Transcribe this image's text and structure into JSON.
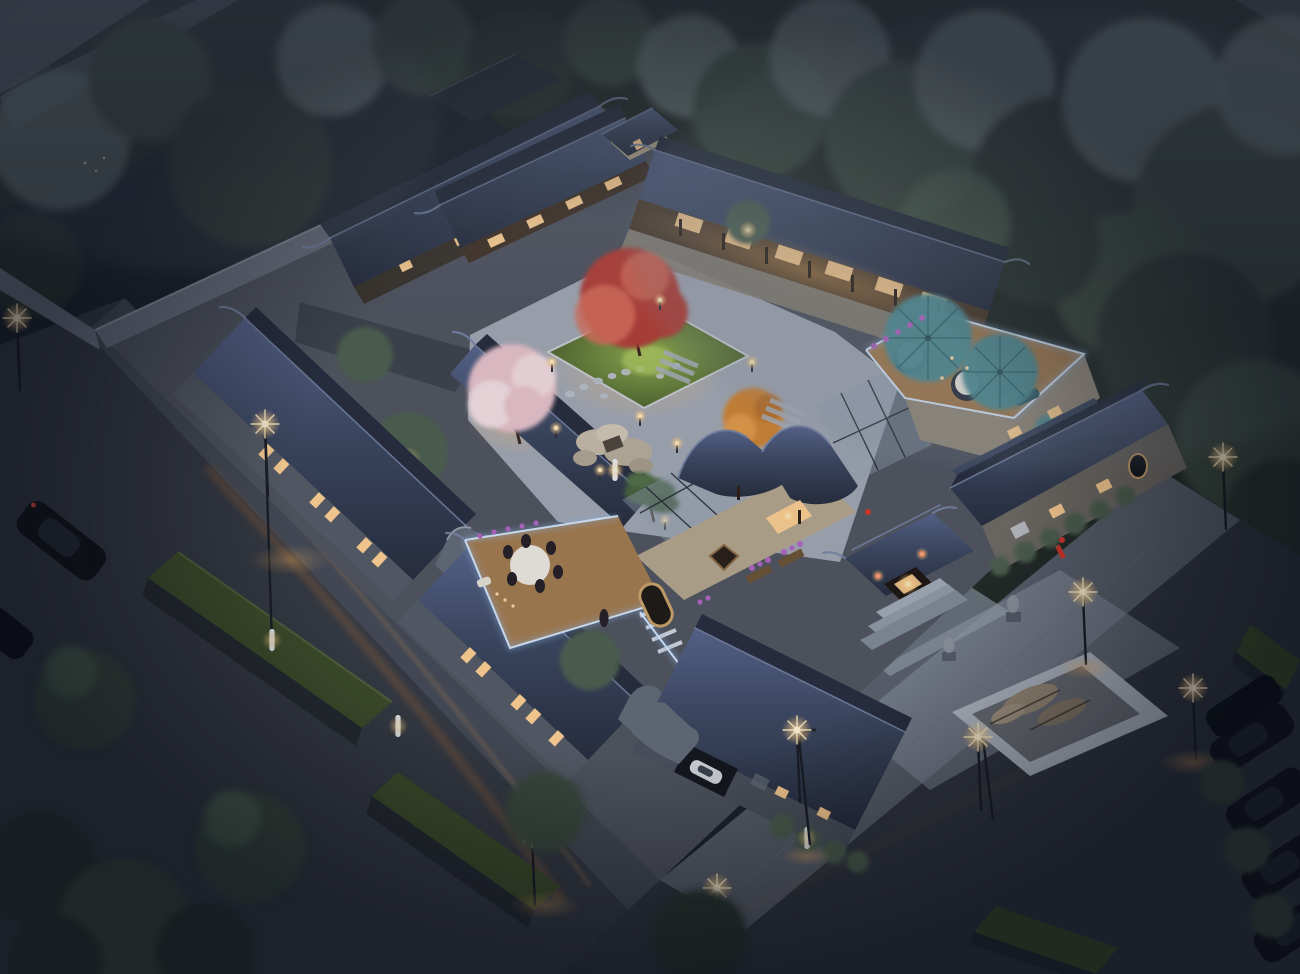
{
  "scene": {
    "subject": "Aerial dusk rendering of a traditional Chinese siheyuan courtyard compound with lit courtyards, rooftop terraces and surrounding streets",
    "time_of_day": "dusk / night",
    "view": "high-angle aerial, compound oriented diagonally, dark misty forest behind",
    "no_visible_text": true
  },
  "inventory": {
    "tiled_roof_wings": 10,
    "street_lamps": 9,
    "bollard_lights": 5,
    "teal_patio_umbrellas": 2,
    "rooftop_terraces": 2,
    "dining_guests_at_round_table": 6,
    "courtyard_trees": {
      "red_maple": 1,
      "cherry_blossom": 1,
      "autumn_orange": 2,
      "bonsai_pine": 1,
      "green_garden_trees": 3
    },
    "street_trees": 6,
    "parked_dark_cars": 5,
    "moving_dark_sedan": 1,
    "white_car_in_carport": 1,
    "stone_lions": 2,
    "red_lanterns": 4,
    "grass_planter_boxes": 4,
    "central_lawn_with_stepping_stones": 1,
    "taihu_rock_table": 1,
    "marble_rock_water_feature": 1,
    "entrance_gate_with_steps": 1,
    "glass_canopy_walkways": 3,
    "light_streaks_on_street": 2,
    "fireflies": 9
  },
  "palette": {
    "bg_dark": "#1d232c",
    "forest_dark": "#222a26",
    "tree_dark": "#2a352e",
    "tree_mid": "#3a4a3e",
    "tree_light": "#4e6150",
    "tree_pale": "#6c7a77",
    "mist": "#7c8894",
    "road": "#363b43",
    "road_side": "#454b55",
    "plaza": "#5a616c",
    "plaza_pale": "#8d96a2",
    "marble": "#b6bec8",
    "roof_dark": "#272e3e",
    "roof_mid": "#3c4860",
    "roof_light": "#57658a",
    "roof_pale": "#7786a6",
    "wall_grey": "#5f646e",
    "wall_light": "#878c96",
    "brick_cream": "#b3a68d",
    "wood": "#7a5c3a",
    "wood_dark": "#45352a",
    "warm_glow": "#ffd193",
    "warm_deep": "#e0873f",
    "streak": "#b5713b",
    "lawn": "#51682f",
    "lawn_lit": "#8cab4f",
    "maple": "#b24038",
    "maple_hi": "#d9705c",
    "blossom": "#e7c3cb",
    "blossom_hi": "#f3dfe2",
    "autumn": "#cd8434",
    "teal": "#4f8e96",
    "teal_dark": "#35656d",
    "led_blue": "#d9ecff",
    "led_halo": "#8fb7e8",
    "deck": "#a37c50",
    "stone": "#b9bfc7",
    "car_dark": "#121519",
    "car_white": "#d7dade",
    "flower_purple": "#b066c2",
    "lantern_red": "#d4372a",
    "glass": "#93a3b3"
  }
}
